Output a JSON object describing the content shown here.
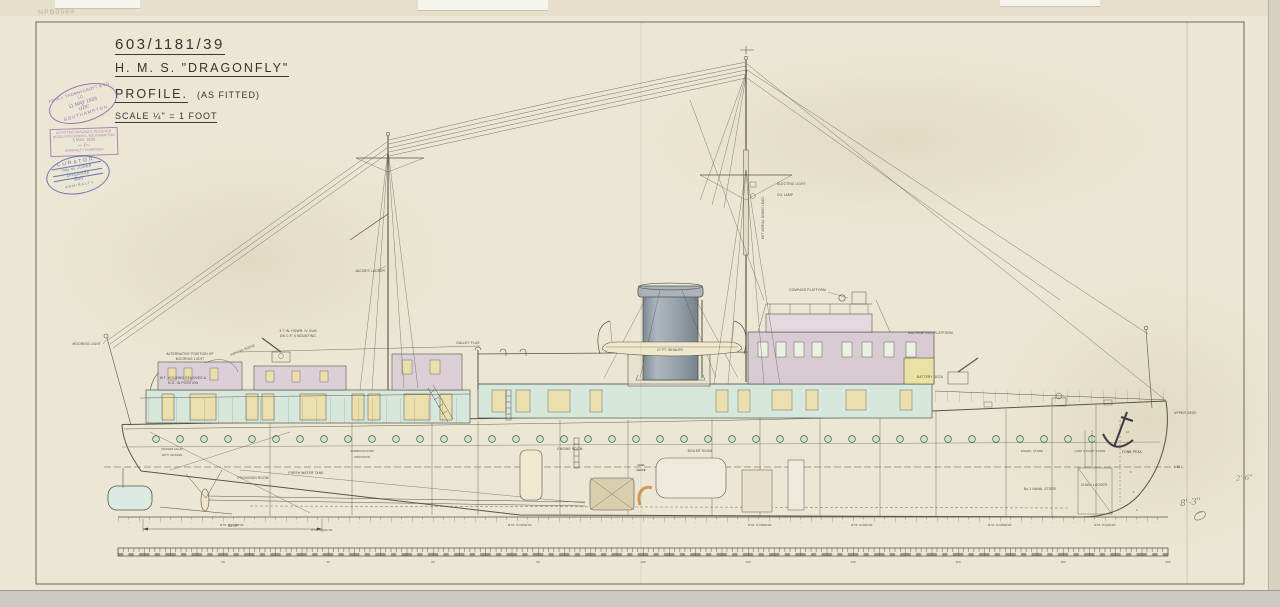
{
  "page": {
    "corner_mark": "NPB0569"
  },
  "title_block": {
    "drawing_number": "603/1181/39",
    "ship_name": "H. M. S.  \"DRAGONFLY\"",
    "view": "PROFILE.",
    "view_note": "(AS FITTED)",
    "scale": "SCALE ¼\" = 1 FOOT"
  },
  "stamps": {
    "builder_oval": {
      "arc_top": "JOHN I. THORNYCROFT & CO. LD.",
      "date": "11 MAY 1939",
      "initials": "abc",
      "arc_bottom": "SOUTHAMPTON"
    },
    "receipt": {
      "line1": "AS FITTED DRAWINGS RECEIVED",
      "line2": "WOOLSTON WORKS, SOUTHAMPTON",
      "date": "5 MAY 1939",
      "line3": "ADMIRALTY OVERSEER"
    },
    "curator": {
      "arc_top": "CURATOR",
      "field1_label": "Neg. No.",
      "field1_value": "33969",
      "field2_value": "Dragonfly",
      "field3_value": "Roll",
      "arc_bottom": "ADMIRALTY"
    }
  },
  "annotations": [
    "MOORING LIGHT",
    "ALTERNATIVE POSITION OF",
    "MOORING LIGHT",
    "W.T. HOUSING REMOVED &",
    "M.G. IN POSITION",
    "3·7 IN. HOWR. IV GUN",
    "ON C.P. II MOUNTING",
    "AWNING RIDGE",
    "JACOB'S LADDER",
    "ELECTRIC LIGHT",
    "OIL LAMP",
    "W/T AERIAL DOWN LEAD",
    "GALLEY FLUE",
    "27 FT. WHALER",
    "MACHINE GUN PLATFORM",
    "BATTERY DECK",
    "COMPASS PLATFORM",
    "ENGINE ROOM",
    "COAL",
    "CHUTE",
    "BOILER ROOM",
    "FRESH WATER TANK",
    "PROVISION ROOM",
    "ENGRS. STORE",
    "LAMP & PAINT STORE",
    "CHAIN LOCKER",
    "FORE PEAK",
    "UPPER DECK",
    "L.W.L.",
    "No.1 NAVAL STORE",
    "W.T.B. TO UPPER DK.",
    "W.T.B. TO MAIN DK.",
    "OFFICERS GALLEY",
    "PETTY OFFICERS",
    "WARDROOM STORE",
    "SPIRIT ROOM"
  ],
  "dimension_stern": "92'-4\"",
  "draft_marks": [
    "12",
    "10",
    "8",
    "6",
    "4"
  ],
  "scale_bar": {
    "numbers": [
      "20",
      "40",
      "60",
      "80",
      "100",
      "120",
      "140",
      "160",
      "180",
      "200"
    ]
  },
  "pencil_notes": {
    "note1": "8'-3\"",
    "note2": "2'-6\""
  },
  "colors": {
    "paper": "#ece7d4",
    "line": "#57544a",
    "deckhouse_teal": "#d6e7dc",
    "bridge_pink": "#d8cbd4",
    "window_tan": "#ecdfae",
    "battery_yellow": "#e9e2a4",
    "funnel_grey": "#a3adb5",
    "porthole_green": "#cfe4cf",
    "stamp_purple": "#8a5fa8",
    "stamp_blue": "#5560a8"
  }
}
